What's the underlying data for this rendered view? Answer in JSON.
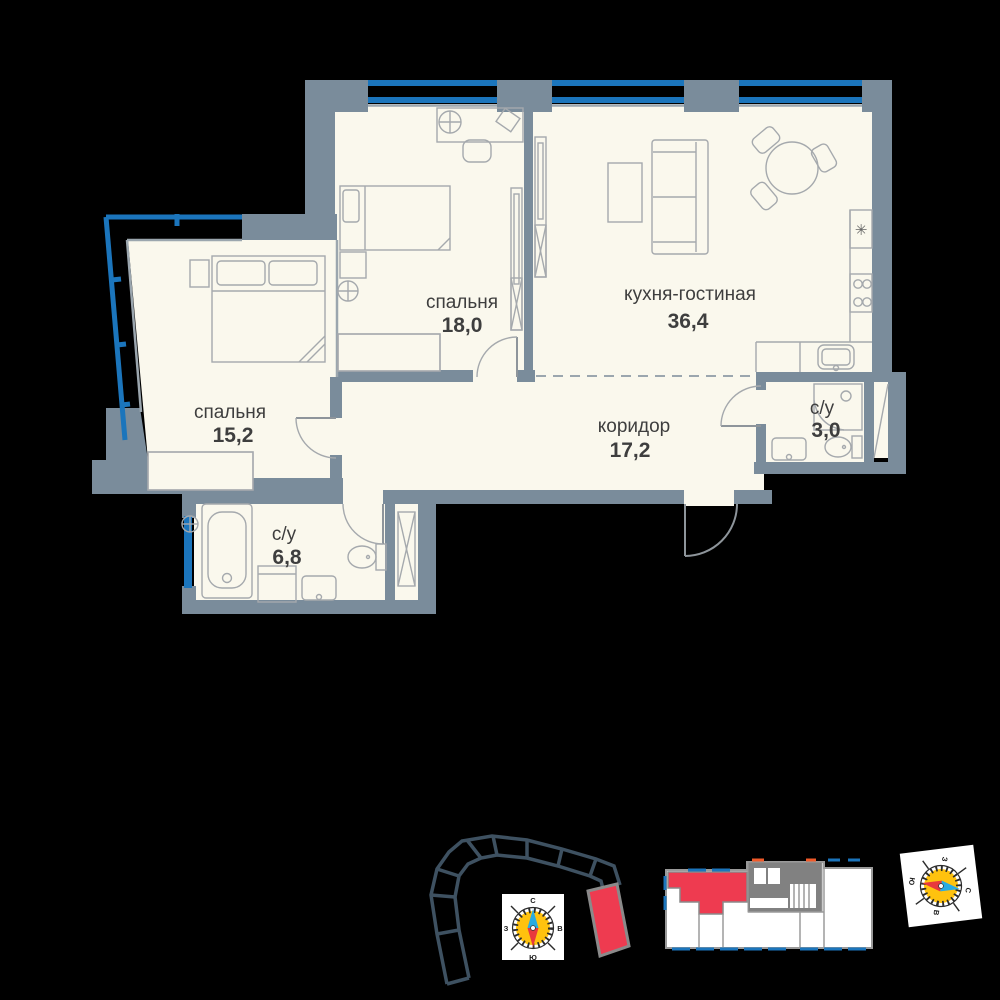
{
  "floor_plan": {
    "rooms": [
      {
        "id": "bedroom-1",
        "name": "спальня",
        "area": "18,0"
      },
      {
        "id": "kitchen-living",
        "name": "кухня-гостиная",
        "area": "36,4"
      },
      {
        "id": "bedroom-2",
        "name": "спальня",
        "area": "15,2"
      },
      {
        "id": "corridor",
        "name": "коридор",
        "area": "17,2"
      },
      {
        "id": "bathroom-small",
        "name": "с/у",
        "area": "3,0"
      },
      {
        "id": "bathroom-large",
        "name": "с/у",
        "area": "6,8"
      }
    ],
    "fridge_glyph": "✳"
  },
  "compass": {
    "north": "С",
    "south": "Ю",
    "west": "З",
    "east": "В"
  },
  "colors": {
    "background": "#000000",
    "wall": "#7A8C9B",
    "floor": "#FAF8ED",
    "window_blue": "#1B75BC",
    "highlight_red": "#EE3B50",
    "site_outline": "#3E5161",
    "compass_yellow": "#FFC20E",
    "compass_needle_blue": "#29ABE2",
    "compass_needle_red": "#E8393D"
  }
}
